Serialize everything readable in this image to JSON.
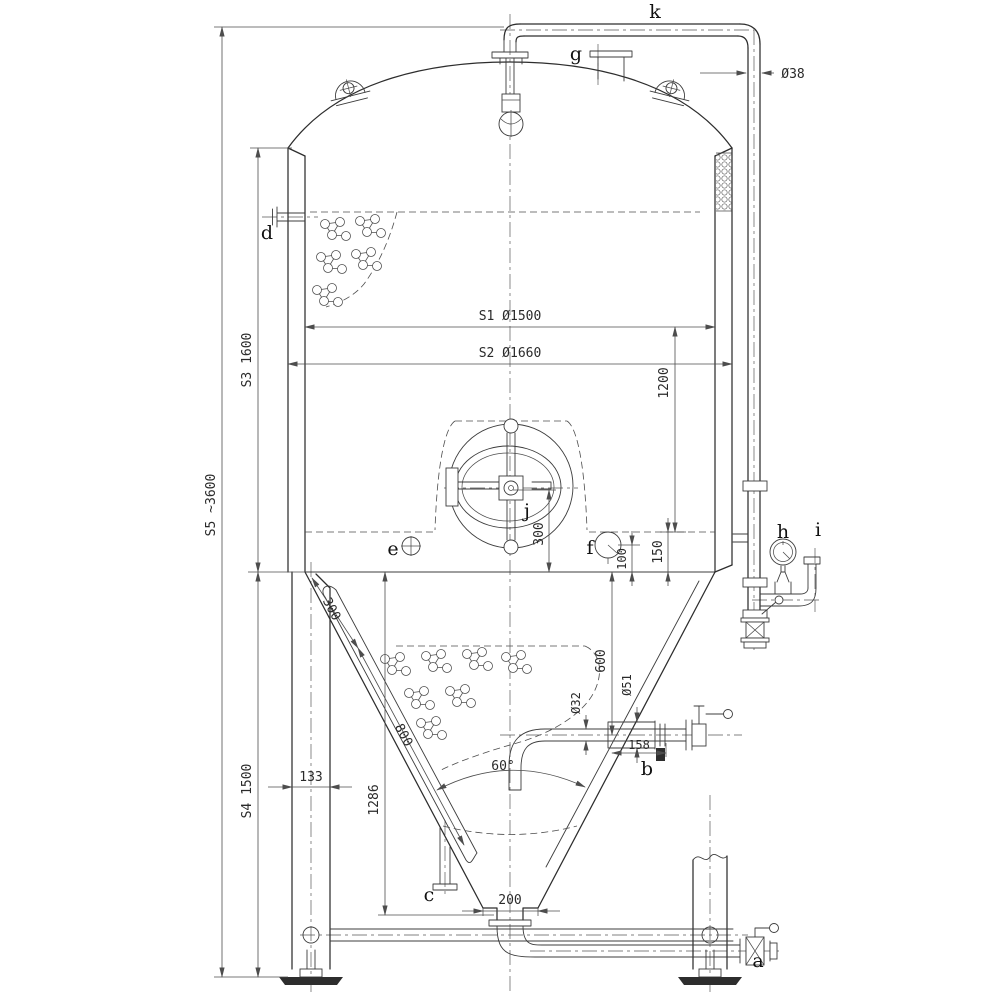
{
  "drawing": {
    "kind": "conical fermenter tank general-arrangement drawing",
    "ports": {
      "a": "a",
      "b": "b",
      "c": "c",
      "d": "d",
      "e": "e",
      "f": "f",
      "g": "g",
      "h": "h",
      "i": "i",
      "j": "j",
      "k": "k"
    },
    "dims": {
      "s1": "S1 Ø1500",
      "s2": "S2 Ø1660",
      "s3": "S3 1600",
      "s4": "S4 1500",
      "s5": "S5 ~3600",
      "top_pipe": "Ø38",
      "shell_1200": "1200",
      "jacket_150": "150",
      "f_100": "100",
      "manway_300": "300",
      "cone_300": "300",
      "cone_800": "800",
      "racking_600": "600",
      "dia_32": "Ø32",
      "dia_51": "Ø51",
      "b_158": "158",
      "leg_133": "133",
      "cone_1286": "1286",
      "outlet_200": "200",
      "cone_angle": "60°"
    },
    "colors": {
      "line": "#2d2d2d",
      "thin": "#4d4d4d",
      "text": "#2a2a2a",
      "bg": "#ffffff"
    }
  }
}
